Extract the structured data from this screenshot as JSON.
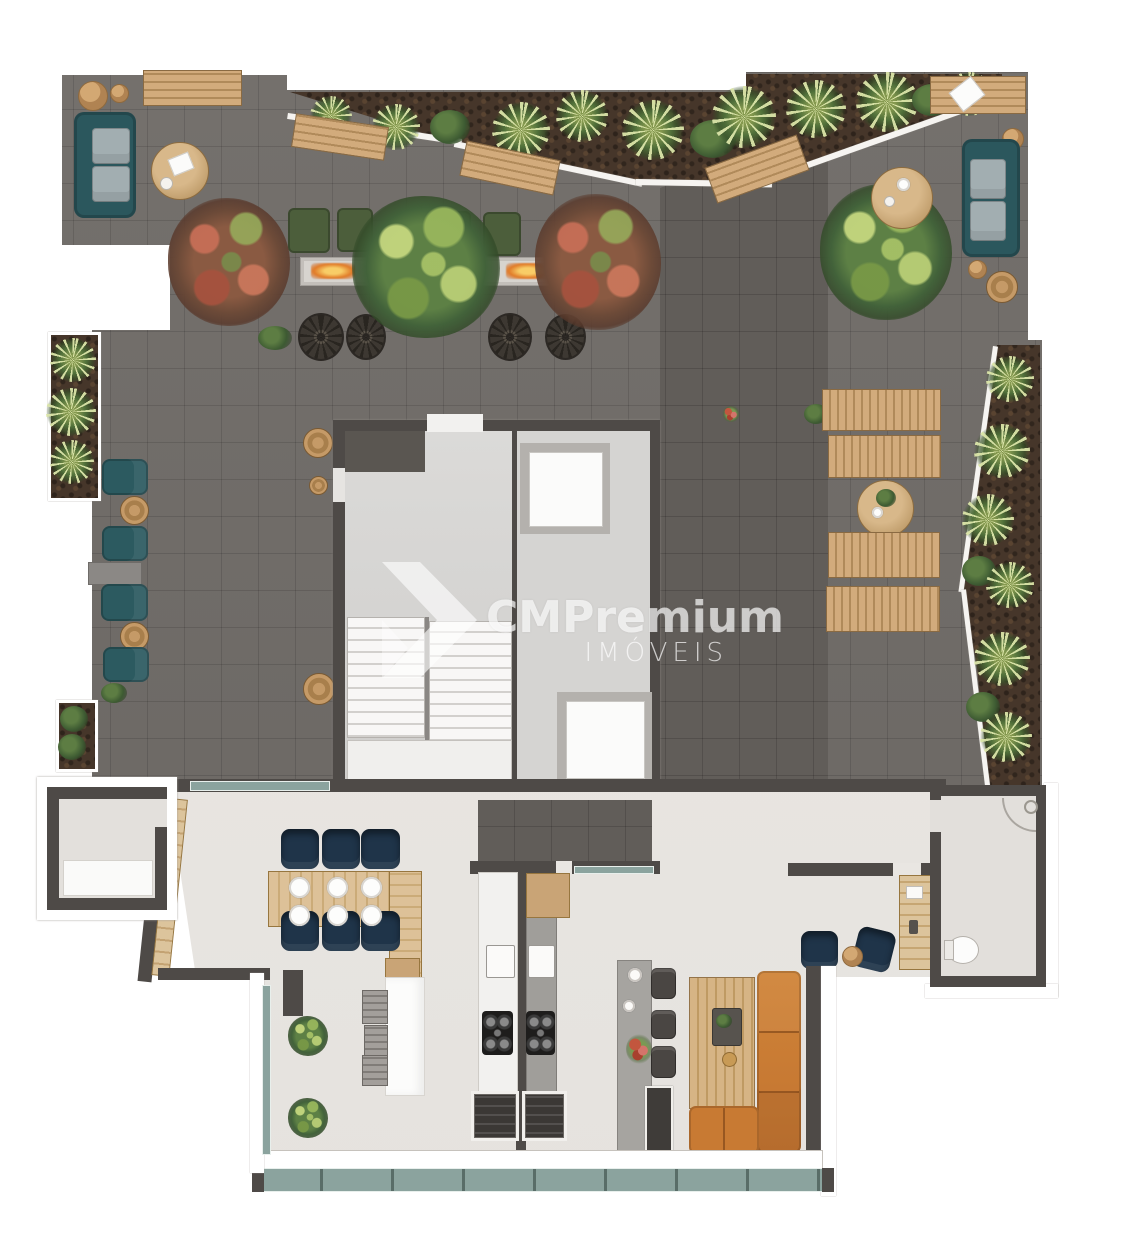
{
  "watermark": {
    "brand": "CMPremium",
    "tagline": "IMÓVEIS"
  },
  "palette": {
    "terrace_tile": "#6f6b67",
    "terrace_tile_dark": "#615d59",
    "planter_soil": "#46362a",
    "foliage_green": "#5d8045",
    "foliage_light": "#bed27e",
    "foliage_red": "#9e5a45",
    "wood": "#c9a476",
    "sofa_teal": "#2b575d",
    "cushion_gray": "#a2aeb1",
    "bench_green": "#4c5e3b",
    "fire_orange": "#e07a28",
    "wall_dark": "#4e4a47",
    "wall_white": "#ffffff",
    "core_floor": "#d8d7d5",
    "interior_floor": "#e9e6e2",
    "chair_navy": "#1f3449",
    "sofa_orange": "#c87a33",
    "counter_gray": "#a09e9a",
    "appliance_dark": "#3b3835",
    "glass_teal": "#8ba39e"
  },
  "elements": {
    "terrace": [
      "teal-sofa",
      "round-coffee-table",
      "wood-bench",
      "ottoman-pouf",
      "green-fire-bench",
      "linear-fire-pit",
      "wire-mesh-chair",
      "flowering-tree",
      "green-tree",
      "teal-lounge-chair",
      "wood-side-table",
      "sun-lounger",
      "round-dining-table",
      "planter-bed",
      "palm-plant"
    ],
    "core": [
      "stair-flight",
      "stair-landing",
      "elevator-cab",
      "elevator-cab"
    ],
    "interior": [
      "dining-table",
      "navy-dining-chair",
      "plate-setting",
      "wood-sideboard",
      "kitchen-island",
      "bar-stool",
      "sink",
      "cooktop",
      "barbecue-grill",
      "pendant-lamp",
      "bar-island",
      "lounge-wood-table",
      "orange-sectional-sofa",
      "writing-desk",
      "navy-armchair",
      "toilet",
      "shower-corner",
      "glass-window-band"
    ]
  }
}
